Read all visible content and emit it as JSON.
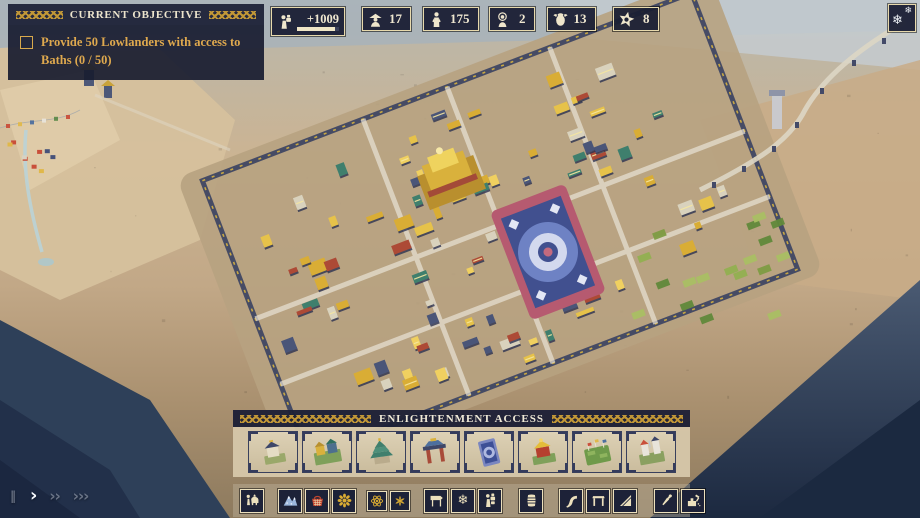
{
  "colors": {
    "panel_bg": "#1b1f36",
    "panel_border": "#e7d9ac",
    "gold_text": "#dfa94e",
    "light_text": "#f0ead8",
    "gold_pattern": "#c99d38",
    "parchment": "#d5c7a9",
    "tile_bg": "#1d2238",
    "glyph_cream": "#efe6cc",
    "glyph_gold": "#d9ab33"
  },
  "objective": {
    "title": "CURRENT OBJECTIVE",
    "task": "Provide 50 Lowlanders with access to Baths (0 / 50)",
    "checked": false
  },
  "resources": [
    {
      "name": "porters",
      "icon": "porter-icon",
      "value": "+1009",
      "progress": 0.9
    },
    {
      "name": "lowlanders",
      "icon": "lowlander-icon",
      "value": "17"
    },
    {
      "name": "workers",
      "icon": "worker-icon",
      "value": "175"
    },
    {
      "name": "monks",
      "icon": "monk-icon",
      "value": "2"
    },
    {
      "name": "yaks",
      "icon": "yak-icon",
      "value": "13"
    },
    {
      "name": "prestige",
      "icon": "star-icon",
      "value": "8"
    }
  ],
  "season_button": {
    "icon": "snowflake-icon"
  },
  "speed": {
    "items": [
      {
        "name": "pause",
        "symbol": "‖",
        "active": false
      },
      {
        "name": "play",
        "symbol": "›",
        "active": true
      },
      {
        "name": "fast",
        "symbol": "››",
        "active": false
      },
      {
        "name": "fastest",
        "symbol": "›››",
        "active": false
      }
    ]
  },
  "build_panel": {
    "title": "ENLIGHTENMENT ACCESS",
    "slots": [
      {
        "name": "small-shrine"
      },
      {
        "name": "monastery-complex"
      },
      {
        "name": "pagoda-temple"
      },
      {
        "name": "gate-shrine"
      },
      {
        "name": "mandala-ground"
      },
      {
        "name": "golden-shrine"
      },
      {
        "name": "prayer-garden"
      },
      {
        "name": "stupa-towers"
      }
    ]
  },
  "toolbar": {
    "tiles": [
      {
        "icon": "yak-caravan-icon"
      },
      {
        "icon": "avalanche-icon"
      },
      {
        "icon": "basket-icon"
      },
      {
        "icon": "mandala-icon"
      },
      {
        "icon": "atom-icon",
        "small": true
      },
      {
        "icon": "lotus-icon",
        "small": true
      },
      {
        "icon": "signpost-icon"
      },
      {
        "icon": "snowflake-overlay-icon"
      },
      {
        "icon": "porter-goods-icon"
      },
      {
        "icon": "barrel-icon"
      },
      {
        "icon": "road-icon"
      },
      {
        "icon": "gate-icon"
      },
      {
        "icon": "ramp-icon"
      },
      {
        "icon": "pipette-icon"
      },
      {
        "icon": "demolish-icon"
      }
    ]
  }
}
